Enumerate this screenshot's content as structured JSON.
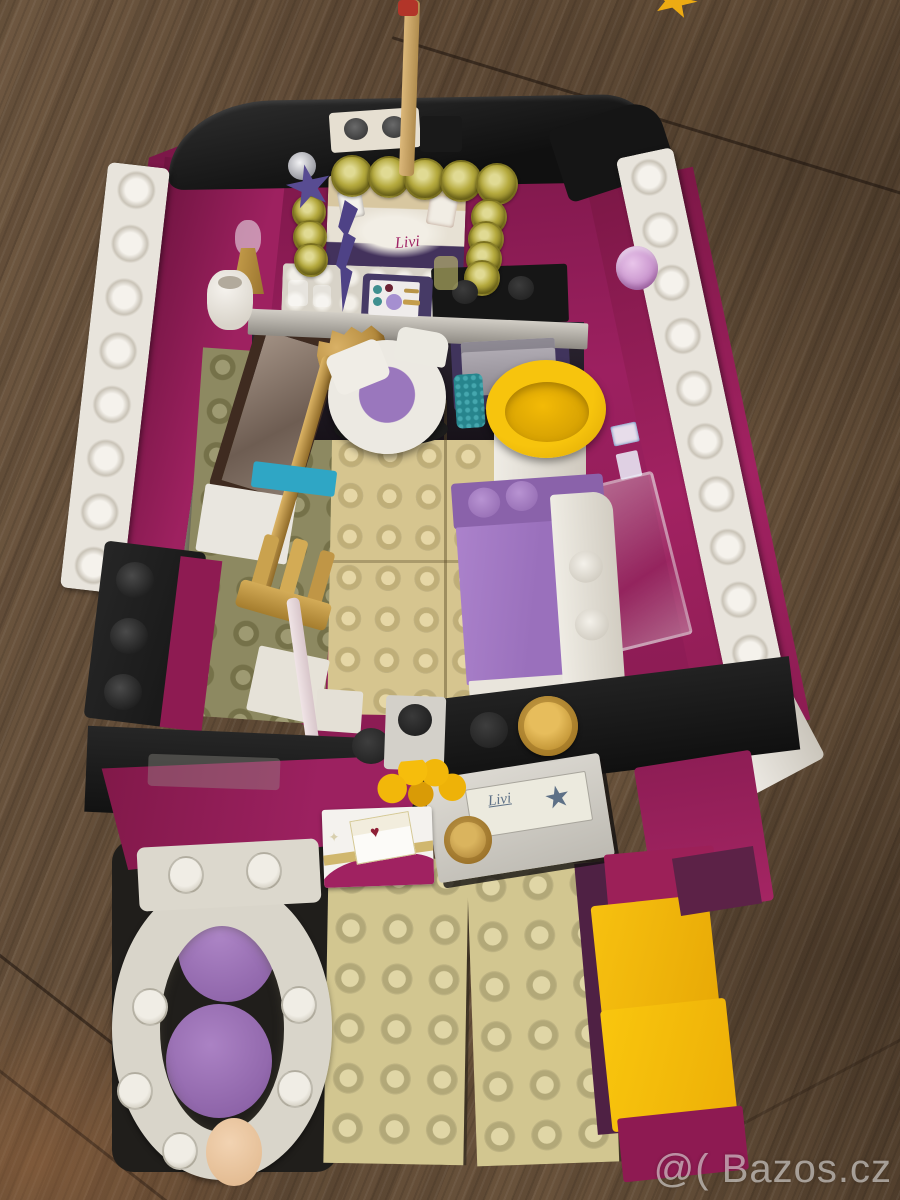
{
  "scene": {
    "description": "Photograph of a LEGO Friends pop-star dressing room playset standing on a brown wooden floor",
    "watermark": "@( Bazos.cz"
  },
  "stickers": {
    "signature": "Livi",
    "star_icon": "★",
    "heart_icon": "♥",
    "sparkle_icon": "✦"
  },
  "colors": {
    "wood": "#64503b",
    "magenta_wall": "#9c2058",
    "black_piece": "#1a1a1a",
    "white_piece": "#e8e4dc",
    "tan_plate": "#d6c58f",
    "olive_plate": "#8d8961",
    "lavender": "#a77fc0",
    "yellow": "#f6c00d",
    "gold": "#c0953f",
    "trans_yellow_light": "#b5aa3e",
    "teal": "#27858d",
    "azure": "#2fa6c5",
    "peach": "#eac7a2",
    "drawer_purple": "#40345c",
    "silver": "#a9a4ad"
  }
}
